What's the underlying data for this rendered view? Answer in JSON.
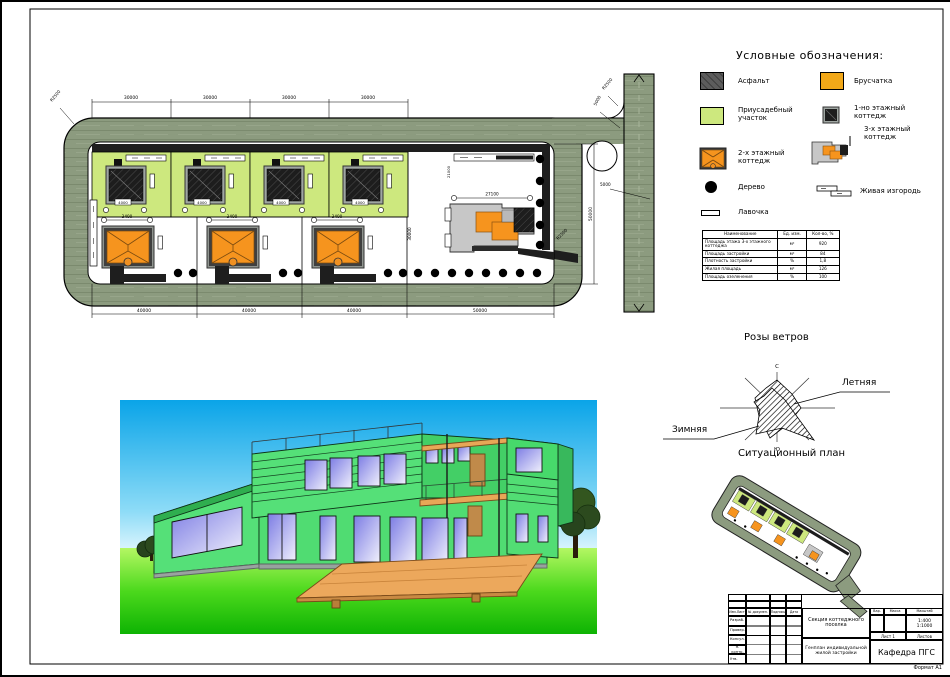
{
  "sheet": {
    "format_note": "Формат А1"
  },
  "legend": {
    "title": "Условные обозначения:",
    "items_left": [
      "Асфальт",
      "Приусадебный участок",
      "2-х этажный коттедж",
      "Дерево",
      "Лавочка"
    ],
    "items_right": [
      "Брусчатка",
      "1-но этажный коттедж",
      "3-х этажный коттедж",
      "Живая изгородь"
    ]
  },
  "indicators_table": {
    "headers": [
      "Наименование",
      "Ед. изм.",
      "Кол-во, %"
    ],
    "rows": [
      [
        "Площадь этажа 3-х этажного коттеджа",
        "м²",
        "920"
      ],
      [
        "Площадь застройки",
        "м²",
        "84"
      ],
      [
        "Плотность застройки",
        "%",
        "1,8"
      ],
      [
        "Жилая площадь",
        "м²",
        "126"
      ],
      [
        "Площадь озеленения",
        "%",
        "100"
      ]
    ]
  },
  "wind_rose": {
    "title": "Розы ветров",
    "north": "С",
    "south": "Ю",
    "winter": "Зимняя",
    "summer": "Летняя"
  },
  "situation_plan": {
    "title": "Ситуационный план"
  },
  "site_plan": {
    "dims": {
      "top": "30000",
      "bottom": "40000",
      "bottom_right": "50000",
      "right_v": "50000",
      "depth": "30000",
      "hedge_v": "21000",
      "cottage1": "4000",
      "cottage2": "3400",
      "cottage3": "27100",
      "road_w": "5000",
      "radius": "R2500"
    }
  },
  "title_block": {
    "header_cols": [
      "Изм.Лист",
      "№ докумен.",
      "Подпись",
      "Дата"
    ],
    "row_labels": [
      "Разраб.",
      "Провер.",
      "Консул.",
      "Н. контр.",
      "Утв."
    ],
    "doc_title": "Секция коттеджного поселка",
    "doc_subtitle": "Генплан индивидуальной жилой застройки",
    "right_headers": [
      "Вар.",
      "Масса",
      "Масштаб"
    ],
    "scale1": "1:400",
    "scale2": "1:1000",
    "sheet_label": "Лист 1",
    "sheets_label": "Листов",
    "department": "Кафедра ПГС"
  },
  "colors": {
    "road": "#8C9B7F",
    "plot_green": "#CDE87E",
    "cottage_orange": "#F6941E",
    "asphalt": "#1E1E1E",
    "paving": "#F2A818"
  }
}
